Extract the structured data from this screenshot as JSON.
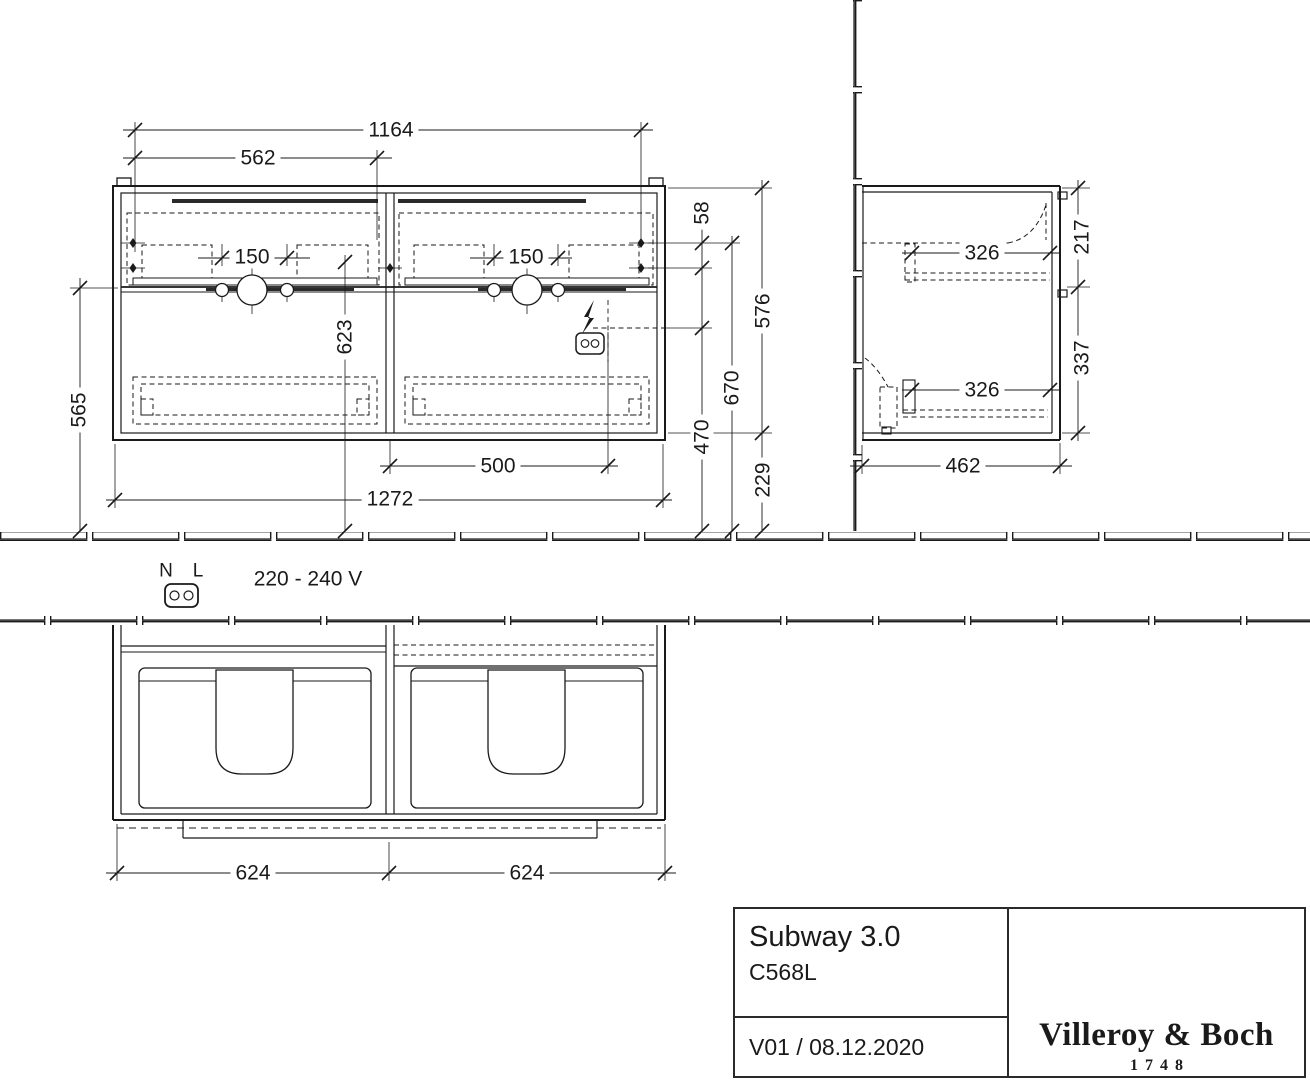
{
  "title_block": {
    "series": "Subway 3.0",
    "model": "C568L",
    "version": "V01 / 08.12.2020",
    "brand": "Villeroy & Boch",
    "brand_founded": "1748"
  },
  "electrical": {
    "neutral_label": "N",
    "line_label": "L",
    "voltage": "220 - 240 V"
  },
  "dimensions_mm": {
    "front": {
      "top_fixing_width": "1164",
      "left_half_width": "562",
      "tap_spacing_left": "150",
      "tap_spacing_right": "150",
      "fixing_hole_gap": "58",
      "cabinet_height": "576",
      "fixing_holes_above_floor": "670",
      "socket_above_floor": "470",
      "underside_above_floor": "229",
      "drain_above_floor": "565",
      "tap_line_above_floor": "623",
      "socket_offset_from_centre": "500",
      "overall_width": "1272"
    },
    "side": {
      "upper_drawer_depth": "326",
      "lower_drawer_depth": "326",
      "upper_front_height": "217",
      "lower_front_height": "337",
      "cabinet_depth": "462"
    },
    "plan": {
      "left_drawer_width": "624",
      "right_drawer_width": "624"
    }
  }
}
